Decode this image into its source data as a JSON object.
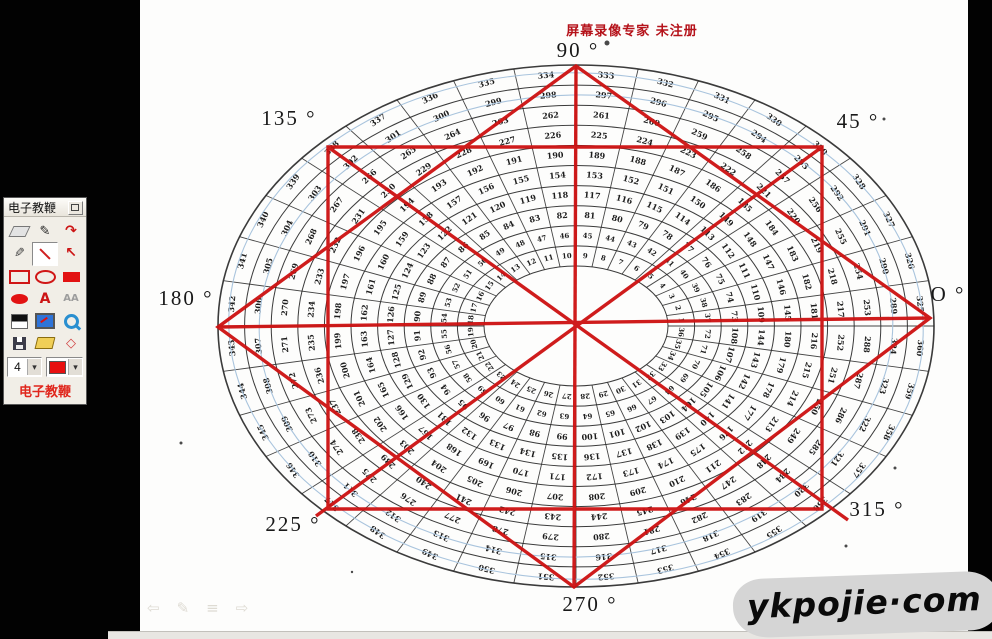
{
  "banner": {
    "text": "屏幕录像专家  未注册"
  },
  "watermark": {
    "text": "ykpojie·com"
  },
  "colors": {
    "annotation_red": "#cd1111",
    "banner_red": "#b5121a",
    "chart_ink": "#262626",
    "guide_blue": "#a9c4dd",
    "palette_red": "#e0261c"
  },
  "palette": {
    "title": "电子教鞭",
    "footer": "电子教鞭",
    "size_value": "4",
    "combo_arrow": "▾",
    "tools": [
      {
        "name": "eraser-tool",
        "kind": "eraser"
      },
      {
        "name": "pen-tool",
        "kind": "glyph",
        "glyph": "✎",
        "color": "#222",
        "size": 13
      },
      {
        "name": "clear-strokes-tool",
        "kind": "glyph",
        "glyph": "↷",
        "color": "#cc1414",
        "size": 14
      },
      {
        "name": "marker-tool",
        "kind": "glyph-flip",
        "glyph": "✎",
        "color": "#3a3a3a",
        "size": 13
      },
      {
        "name": "line-tool",
        "kind": "line",
        "selected": true
      },
      {
        "name": "arrow-tool",
        "kind": "glyph",
        "glyph": "↖",
        "color": "#cc1414",
        "size": 14
      },
      {
        "name": "rectangle-outline-tool",
        "kind": "rect-o"
      },
      {
        "name": "ellipse-outline-tool",
        "kind": "ell-o"
      },
      {
        "name": "rectangle-filled-tool",
        "kind": "rect-f"
      },
      {
        "name": "ellipse-filled-tool",
        "kind": "ell-f"
      },
      {
        "name": "text-tool",
        "kind": "glyph",
        "glyph": "A",
        "color": "#cc1414",
        "size": 14
      },
      {
        "name": "font-tool",
        "kind": "glyph",
        "glyph": "AA",
        "color": "#9d9d9d",
        "size": 10
      },
      {
        "name": "black-white-swatch",
        "kind": "bw"
      },
      {
        "name": "screen-capture-tool",
        "kind": "monitor"
      },
      {
        "name": "zoom-tool",
        "kind": "mag"
      },
      {
        "name": "save-button",
        "kind": "floppy"
      },
      {
        "name": "open-button",
        "kind": "folder"
      },
      {
        "name": "diamond-shape-tool",
        "kind": "glyph",
        "glyph": "◇",
        "color": "#d04040",
        "size": 13
      }
    ]
  },
  "nav": {
    "icons": [
      {
        "name": "previous-slide-button",
        "glyph": "⇦"
      },
      {
        "name": "pen-menu-button",
        "glyph": "✎"
      },
      {
        "name": "slide-menu-button",
        "glyph": "≡"
      },
      {
        "name": "next-slide-button",
        "glyph": "⇨"
      }
    ]
  },
  "chart": {
    "type": "degree-wheel-table",
    "description": "Scanned elliptical 360-degree number wheel divided into concentric rings and radial sectors filled with small serial numbers",
    "geometry": {
      "cx": 576,
      "cy": 326,
      "outer_a": 358,
      "outer_b": 261,
      "hole_a": 92,
      "hole_b": 60,
      "rings": 10,
      "sectors": 36,
      "spoke_step_deg": 10
    },
    "numbering": {
      "start": 1,
      "end": 360,
      "per_ring": 36,
      "direction": "ccw"
    },
    "angle_labels": [
      {
        "id": "90",
        "text": "90 °",
        "x": 578,
        "y": 57
      },
      {
        "id": "45",
        "text": "45 °",
        "x": 858,
        "y": 128
      },
      {
        "id": "135",
        "text": "135 °",
        "x": 289,
        "y": 125
      },
      {
        "id": "180",
        "text": "180 °",
        "x": 186,
        "y": 305
      },
      {
        "id": "0",
        "text": "O °",
        "x": 948,
        "y": 301
      },
      {
        "id": "225",
        "text": "225 °",
        "x": 293,
        "y": 531
      },
      {
        "id": "270",
        "text": "270 °",
        "x": 590,
        "y": 611
      },
      {
        "id": "315",
        "text": "315 °",
        "x": 877,
        "y": 516
      }
    ],
    "guide_ellipses": [
      {
        "scale": 0.97,
        "tilt": 1.6
      },
      {
        "scale": 0.885,
        "tilt": -1.2
      }
    ],
    "artifacts": [
      {
        "x": 607,
        "y": 43,
        "r": 2.5
      },
      {
        "x": 884,
        "y": 119,
        "r": 1.5
      },
      {
        "x": 181,
        "y": 443,
        "r": 1.5
      },
      {
        "x": 895,
        "y": 468,
        "r": 1.5
      },
      {
        "x": 352,
        "y": 572,
        "r": 1.2
      },
      {
        "x": 846,
        "y": 546,
        "r": 1.5
      }
    ]
  },
  "overlay": {
    "color": "#cd1111",
    "stroke_width": 3.4,
    "rect": [
      328,
      147,
      822,
      509
    ],
    "diamond": [
      [
        576,
        66
      ],
      [
        930,
        318
      ],
      [
        574,
        587
      ],
      [
        218,
        327
      ]
    ],
    "lines": [
      [
        576,
        66,
        574,
        587
      ],
      [
        218,
        327,
        930,
        318
      ],
      [
        328,
        147,
        848,
        520
      ],
      [
        822,
        147,
        316,
        516
      ]
    ]
  }
}
